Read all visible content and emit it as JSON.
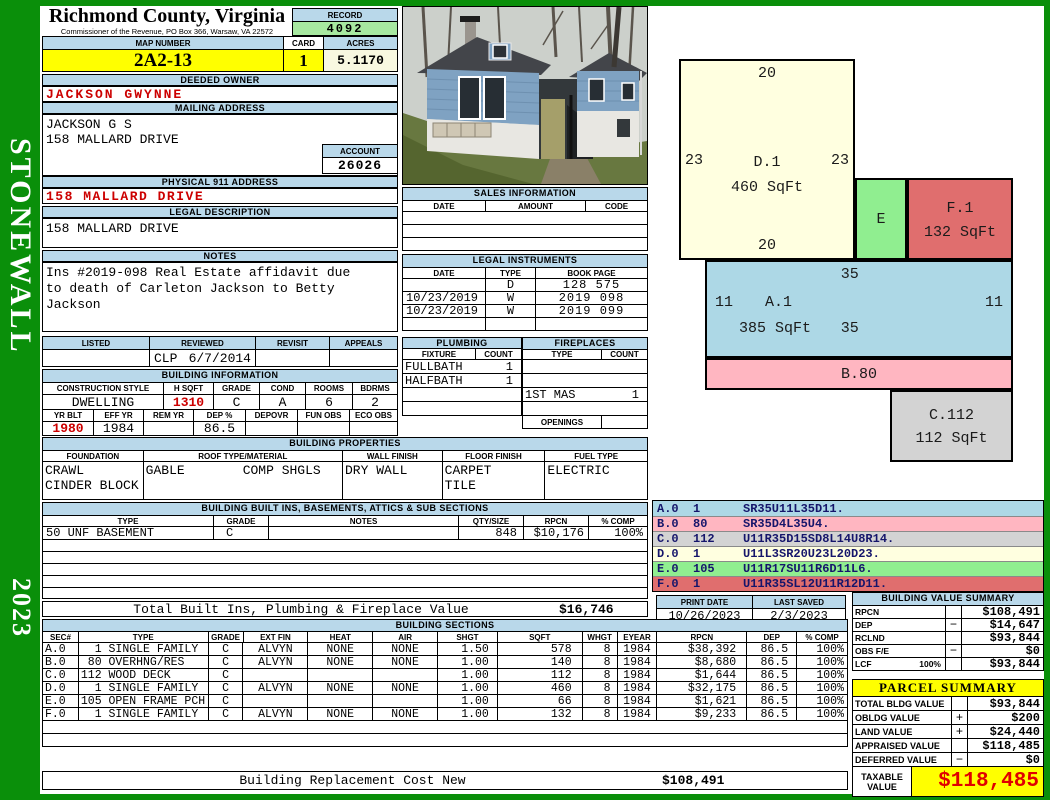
{
  "frame": {
    "district": "STONEWALL",
    "year": "2023"
  },
  "colors": {
    "frame_green": "#0a8f0a",
    "header_bar": "#b9d8ea",
    "highlight_yellow": "#ffff00",
    "record_green": "#a7e8a0",
    "acres_cream": "#f8f8e0",
    "alert_red": "#cc0000"
  },
  "header": {
    "county": "Richmond County, Virginia",
    "commissioner_line": "Commissioner of the Revenue, PO Box 366, Warsaw, VA 22572",
    "record_label": "RECORD",
    "record_value": "4092",
    "map_number_label": "MAP NUMBER",
    "map_number": "2A2-13",
    "card_label": "CARD",
    "card": "1",
    "acres_label": "ACRES",
    "acres": "5.1170"
  },
  "owner": {
    "deeded_owner_label": "DEEDED OWNER",
    "deeded_owner": "JACKSON GWYNNE",
    "mailing_address_label": "MAILING ADDRESS",
    "mailing_lines": [
      "JACKSON G S",
      "158 MALLARD DRIVE",
      "WARSAW, VA 22572-2512"
    ],
    "account_label": "ACCOUNT",
    "account": "26026",
    "physical_address_label": "PHYSICAL 911 ADDRESS",
    "physical_address": "158 MALLARD DRIVE",
    "legal_description_label": "LEGAL DESCRIPTION",
    "legal_description": "158 MALLARD DRIVE",
    "notes_label": "NOTES",
    "notes_lines": [
      "Ins #2019-098 Real Estate affidavit due",
      "to death of Carleton Jackson to Betty",
      "Jackson"
    ]
  },
  "sales": {
    "title": "SALES INFORMATION",
    "columns": [
      "DATE",
      "AMOUNT",
      "CODE"
    ]
  },
  "legal_instruments": {
    "title": "LEGAL INSTRUMENTS",
    "columns": [
      "DATE",
      "TYPE",
      "BOOK PAGE"
    ],
    "rows": [
      {
        "date": "",
        "type": "D",
        "book": "128 575"
      },
      {
        "date": "10/23/2019",
        "type": "W",
        "book": "2019 098"
      },
      {
        "date": "10/23/2019",
        "type": "W",
        "book": "2019 099"
      },
      {
        "date": "",
        "type": "",
        "book": ""
      }
    ]
  },
  "plumbing": {
    "title": "PLUMBING",
    "columns": [
      "FIXTURE",
      "COUNT"
    ],
    "rows": [
      {
        "fixture": "FULLBATH",
        "count": "1"
      },
      {
        "fixture": "HALFBATH",
        "count": "1"
      },
      {
        "fixture": "",
        "count": ""
      },
      {
        "fixture": "",
        "count": ""
      }
    ]
  },
  "fireplaces": {
    "title": "FIREPLACES",
    "columns": [
      "TYPE",
      "COUNT"
    ],
    "rows": [
      {
        "type": "",
        "count": ""
      },
      {
        "type": "",
        "count": ""
      },
      {
        "type": "1ST MAS",
        "count": "1"
      },
      {
        "type": "",
        "count": ""
      }
    ],
    "openings_label": "OPENINGS",
    "openings_value": ""
  },
  "visits": {
    "columns": [
      "LISTED",
      "REVIEWED",
      "REVISIT",
      "APPEALS"
    ],
    "listed": "",
    "reviewed_by": "CLP",
    "reviewed_date": "6/7/2014",
    "revisit": "",
    "appeals": ""
  },
  "building_info": {
    "title": "BUILDING INFORMATION",
    "row1_headers": [
      "CONSTRUCTION STYLE",
      "H SQFT",
      "GRADE",
      "COND",
      "ROOMS",
      "BDRMS"
    ],
    "row1_values": [
      "DWELLING",
      "1310",
      "C",
      "A",
      "6",
      "2"
    ],
    "row2_headers": [
      "YR BLT",
      "EFF YR",
      "REM YR",
      "DEP %",
      "DEPOVR",
      "FUN OBS",
      "ECO OBS"
    ],
    "row2_values": [
      "1980",
      "1984",
      "",
      "86.5",
      "",
      "",
      ""
    ]
  },
  "building_properties": {
    "title": "BUILDING PROPERTIES",
    "columns": [
      "FOUNDATION",
      "ROOF TYPE/MATERIAL",
      "WALL FINISH",
      "FLOOR FINISH",
      "FUEL TYPE"
    ],
    "foundation": [
      "CRAWL",
      "CINDER BLOCK"
    ],
    "roof_type": "GABLE",
    "roof_material": "COMP SHGLS",
    "wall_finish": "DRY WALL",
    "floor_finish": [
      "CARPET",
      "TILE"
    ],
    "fuel_type": "ELECTRIC"
  },
  "built_ins": {
    "title": "BUILDING BUILT INS, BASEMENTS, ATTICS & SUB SECTIONS",
    "columns": [
      "TYPE",
      "GRADE",
      "NOTES",
      "QTY/SIZE",
      "RPCN",
      "% COMP"
    ],
    "rows": [
      {
        "type": "50 UNF BASEMENT",
        "grade": "C",
        "notes": "",
        "qty": "848",
        "rpcn": "$10,176",
        "comp": "100%"
      }
    ]
  },
  "totals": {
    "built_ins_label": "Total Built Ins, Plumbing & Fireplace Value",
    "built_ins_value": "$16,746",
    "replacement_label": "Building Replacement Cost New",
    "replacement_value": "$108,491"
  },
  "sketch": {
    "shapes": {
      "d": {
        "name": "D.1",
        "area": "460 SqFt",
        "top": "20",
        "left": "23",
        "right": "23",
        "bottom": "20",
        "color": "#ffffe0"
      },
      "e": {
        "name": "E",
        "color": "#90ee90"
      },
      "f": {
        "name": "F.1",
        "area": "132 SqFt",
        "color": "#e06e6e"
      },
      "a": {
        "name": "A.1",
        "area": "385 SqFt",
        "top": "35",
        "left": "11",
        "right": "11",
        "bottom": "35",
        "color": "#add8e6"
      },
      "b": {
        "name": "B.80",
        "color": "#ffb6c1"
      },
      "c": {
        "name": "C.112",
        "area": "112 SqFt",
        "color": "#d3d3d3"
      }
    },
    "legend": [
      {
        "code": "A.0",
        "qty": "1",
        "vector": "SR35U11L35D11.",
        "color": "#add8e6"
      },
      {
        "code": "B.0",
        "qty": "80",
        "vector": "SR35D4L35U4.",
        "color": "#ffb6c1"
      },
      {
        "code": "C.0",
        "qty": "112",
        "vector": "U11R35D15SD8L14U8R14.",
        "color": "#d3d3d3"
      },
      {
        "code": "D.0",
        "qty": "1",
        "vector": "U11L3SR20U23L20D23.",
        "color": "#ffffe0"
      },
      {
        "code": "E.0",
        "qty": "105",
        "vector": "U11R17SU11R6D11L6.",
        "color": "#90ee90"
      },
      {
        "code": "F.0",
        "qty": "1",
        "vector": "U11R35SL12U11R12D11.",
        "color": "#e06e6e"
      }
    ]
  },
  "print_info": {
    "print_date_label": "PRINT DATE",
    "print_date": "10/26/2023",
    "last_saved_label": "LAST SAVED",
    "last_saved": "2/3/2023"
  },
  "building_value_summary": {
    "title": "BUILDING VALUE SUMMARY",
    "rows": [
      {
        "label": "RPCN",
        "pct": "",
        "sign": "",
        "value": "$108,491"
      },
      {
        "label": "DEP",
        "pct": "",
        "sign": "−",
        "value": "$14,647"
      },
      {
        "label": "RCLND",
        "pct": "",
        "sign": "",
        "value": "$93,844"
      },
      {
        "label": "OBS F/E",
        "pct": "",
        "sign": "−",
        "value": "$0"
      },
      {
        "label": "LCF",
        "pct": "100%",
        "sign": "",
        "value": "$93,844"
      }
    ]
  },
  "building_sections": {
    "title": "BUILDING SECTIONS",
    "columns": [
      "SEC#",
      "TYPE",
      "GRADE",
      "EXT FIN",
      "HEAT",
      "AIR",
      "SHGT",
      "SQFT",
      "WHGT",
      "EYEAR",
      "RPCN",
      "DEP",
      "% COMP"
    ],
    "rows": [
      {
        "sec": "A.0",
        "type": "  1 SINGLE FAMILY",
        "grade": "C",
        "ext": "ALVYN",
        "heat": "NONE",
        "air": "NONE",
        "shgt": "1.50",
        "sqft": "578",
        "whgt": "8",
        "eyear": "1984",
        "rpcn": "$38,392",
        "dep": "86.5",
        "comp": "100%"
      },
      {
        "sec": "B.0",
        "type": " 80 OVERHNG/RES",
        "grade": "C",
        "ext": "ALVYN",
        "heat": "NONE",
        "air": "NONE",
        "shgt": "1.00",
        "sqft": "140",
        "whgt": "8",
        "eyear": "1984",
        "rpcn": "$8,680",
        "dep": "86.5",
        "comp": "100%"
      },
      {
        "sec": "C.0",
        "type": "112 WOOD DECK",
        "grade": "C",
        "ext": "",
        "heat": "",
        "air": "",
        "shgt": "1.00",
        "sqft": "112",
        "whgt": "8",
        "eyear": "1984",
        "rpcn": "$1,644",
        "dep": "86.5",
        "comp": "100%"
      },
      {
        "sec": "D.0",
        "type": "  1 SINGLE FAMILY",
        "grade": "C",
        "ext": "ALVYN",
        "heat": "NONE",
        "air": "NONE",
        "shgt": "1.00",
        "sqft": "460",
        "whgt": "8",
        "eyear": "1984",
        "rpcn": "$32,175",
        "dep": "86.5",
        "comp": "100%"
      },
      {
        "sec": "E.0",
        "type": "105 OPEN FRAME PCH",
        "grade": "C",
        "ext": "",
        "heat": "",
        "air": "",
        "shgt": "1.00",
        "sqft": "66",
        "whgt": "8",
        "eyear": "1984",
        "rpcn": "$1,621",
        "dep": "86.5",
        "comp": "100%"
      },
      {
        "sec": "F.0",
        "type": "  1 SINGLE FAMILY",
        "grade": "C",
        "ext": "ALVYN",
        "heat": "NONE",
        "air": "NONE",
        "shgt": "1.00",
        "sqft": "132",
        "whgt": "8",
        "eyear": "1984",
        "rpcn": "$9,233",
        "dep": "86.5",
        "comp": "100%"
      }
    ]
  },
  "parcel_summary": {
    "title": "PARCEL SUMMARY",
    "rows": [
      {
        "label": "TOTAL BLDG VALUE",
        "sign": "",
        "value": "$93,844"
      },
      {
        "label": "OBLDG VALUE",
        "sign": "+",
        "value": "$200"
      },
      {
        "label": "LAND VALUE",
        "sign": "+",
        "value": "$24,440"
      },
      {
        "label": "APPRAISED VALUE",
        "sign": "",
        "value": "$118,485"
      },
      {
        "label": "DEFERRED VALUE",
        "sign": "−",
        "value": "$0"
      }
    ],
    "taxable_label": "TAXABLE VALUE",
    "taxable_value": "$118,485"
  }
}
